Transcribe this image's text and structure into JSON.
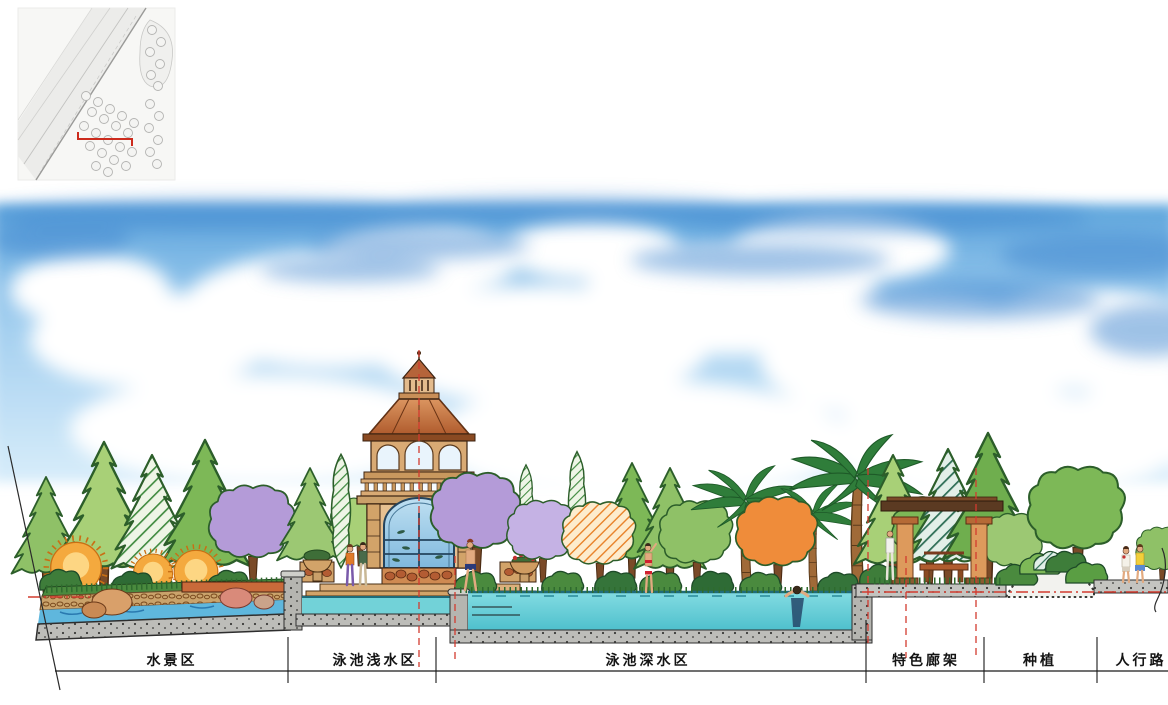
{
  "sections": {
    "items": [
      {
        "label": "水景区"
      },
      {
        "label": "泳池浅水区"
      },
      {
        "label": "泳池深水区"
      },
      {
        "label": "特色廊架"
      },
      {
        "label": "种植"
      },
      {
        "label": "人行路"
      }
    ]
  },
  "minimap": {
    "marker": "section-cut-red-bracket",
    "marker_color": "#cc2b1d"
  },
  "palette": {
    "sky_top": "#5fa6dd",
    "sky_bottom": "#d8edfa",
    "cloud": "#ffffff",
    "pool_deep": "#56c6d1",
    "pool_shallow": "#72d2d8",
    "channel_water": "#5fb7dd",
    "concrete": "#bdbdb9",
    "foliage_light": "#a8d077",
    "foliage_mid": "#7db857",
    "foliage_dark": "#3e7d3a",
    "accent_purple": "#b49bd8",
    "accent_orange": "#f4a93e",
    "roof_terracotta": "#c97a42",
    "stone_tan": "#d9aa74",
    "section_line_red": "#d23b2f",
    "ink": "#1a1a1a"
  }
}
